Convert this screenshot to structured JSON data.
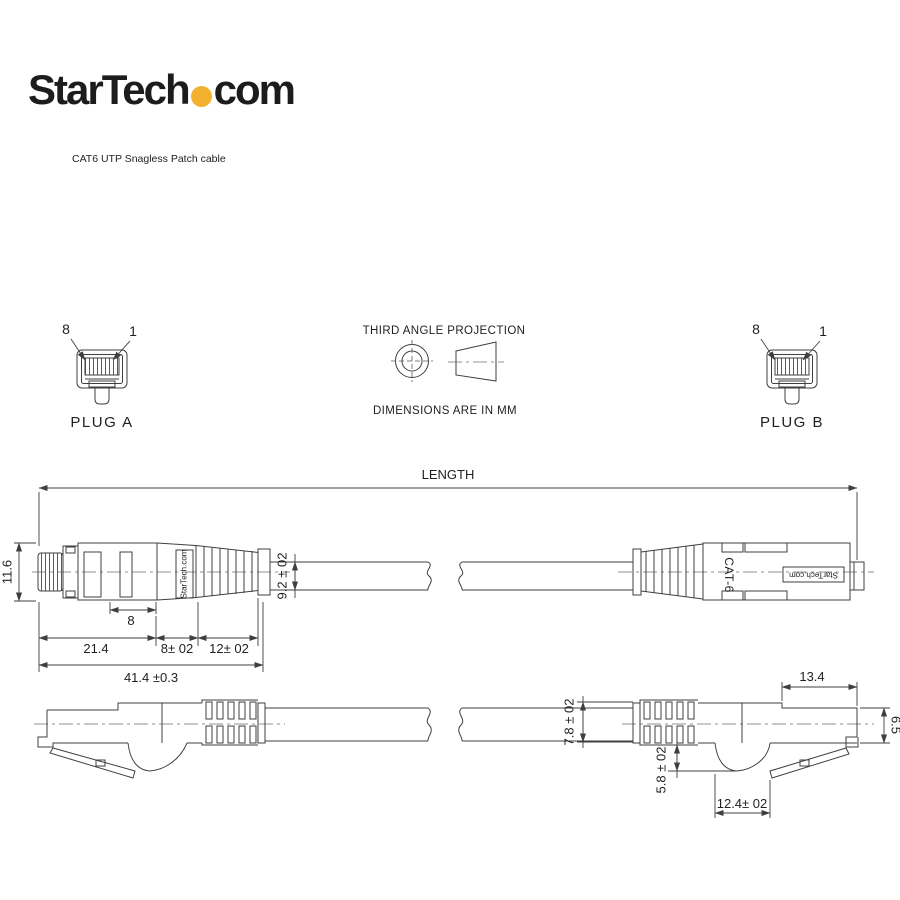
{
  "header": {
    "logo_main": "StarTech",
    "logo_suffix": "com",
    "logo_dot_color": "#F2B230",
    "subtitle": "CAT6 UTP Snagless Patch cable"
  },
  "projection": {
    "title": "THIRD ANGLE PROJECTION",
    "note": "DIMENSIONS ARE IN MM"
  },
  "plug_a": {
    "pin_left": "8",
    "pin_right": "1",
    "label": "PLUG A"
  },
  "plug_b": {
    "pin_left": "8",
    "pin_right": "1",
    "label": "PLUG B"
  },
  "length_dim": {
    "label": "LENGTH"
  },
  "top_view": {
    "connector_brand_vertical": "StarTech.com",
    "connector_type": "CAT-6",
    "connector_brand_plate": "StarTech.com",
    "dims": {
      "plug_height": "11.6",
      "cable_od": "9.2 ± 02",
      "window": "8",
      "plug_body": "21.4",
      "boot_neck": "8± 02",
      "boot_ribs": "12± 02",
      "overall": "41.4 ±0.3"
    }
  },
  "side_view": {
    "dims": {
      "cable_od": "7.8 ± 02",
      "hump_depth": "5.8 ± 02",
      "hump_length": "12.4± 02",
      "tip_length": "13.4",
      "tip_height": "6.5"
    }
  },
  "colors": {
    "line": "#3f3f3f",
    "text": "#1f1f1f",
    "accent_yellow": "#F2B230"
  }
}
